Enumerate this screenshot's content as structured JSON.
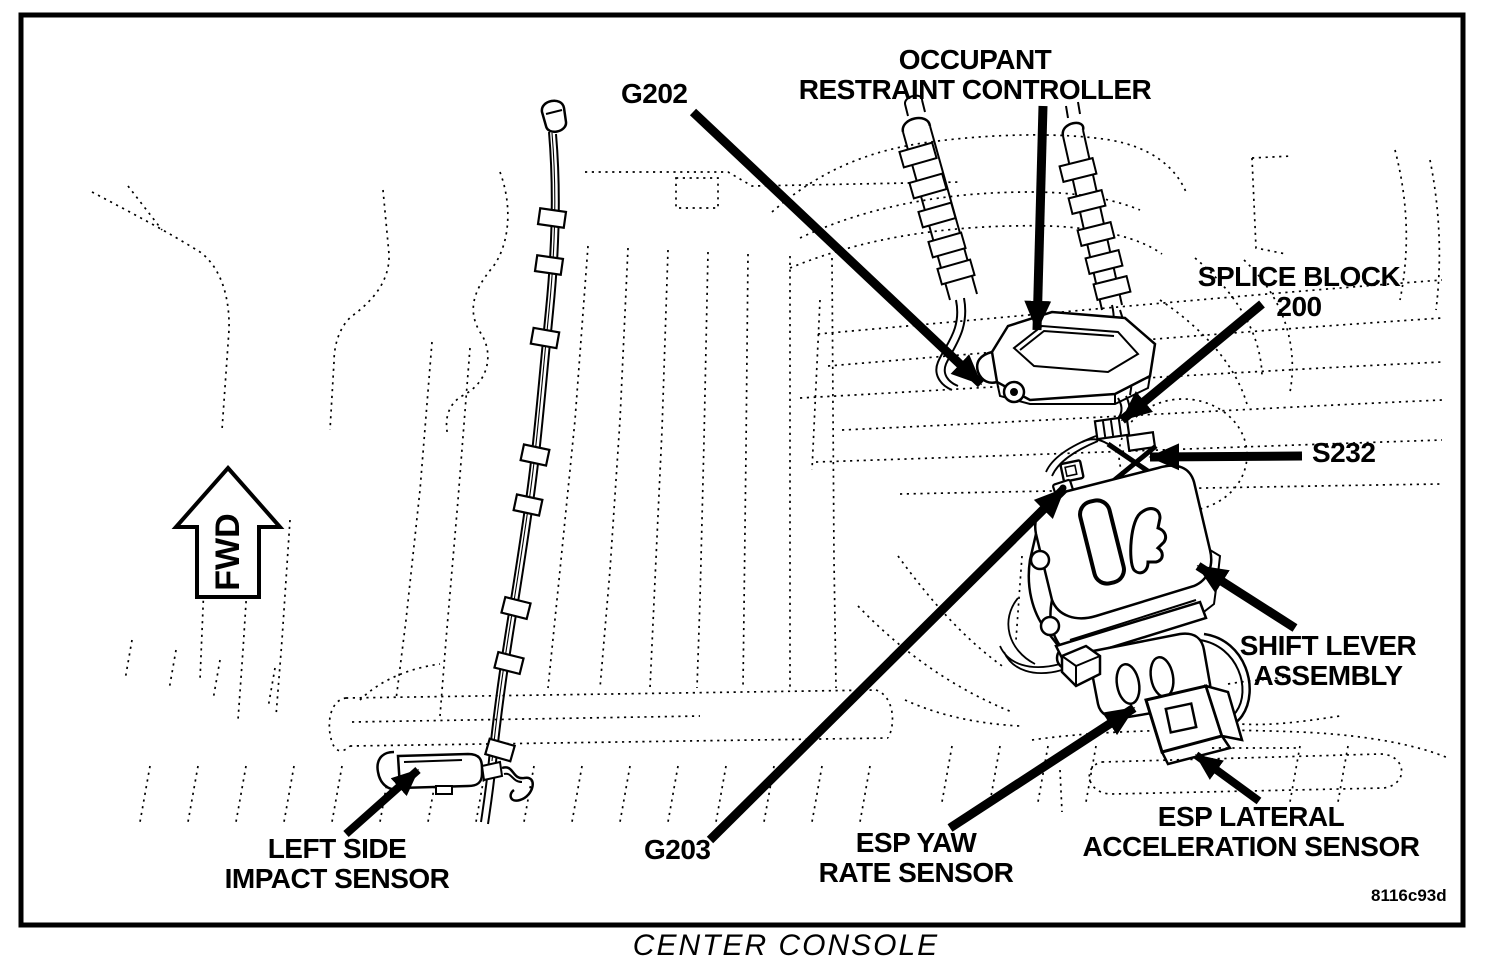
{
  "figure": {
    "caption": "CENTER CONSOLE",
    "code": "8116c93d",
    "fwd_label": "FWD"
  },
  "callouts": {
    "g202": {
      "label": "G202"
    },
    "occupant_restraint_controller": {
      "line1": "OCCUPANT",
      "line2": "RESTRAINT CONTROLLER"
    },
    "splice_block_200": {
      "line1": "SPLICE BLOCK",
      "line2": "200"
    },
    "s232": {
      "label": "S232"
    },
    "shift_lever_assembly": {
      "line1": "SHIFT LEVER",
      "line2": "ASSEMBLY"
    },
    "esp_lateral_acceleration_sensor": {
      "line1": "ESP LATERAL",
      "line2": "ACCELERATION SENSOR"
    },
    "esp_yaw_rate_sensor": {
      "line1": "ESP YAW",
      "line2": "RATE SENSOR"
    },
    "g203": {
      "label": "G203"
    },
    "left_side_impact_sensor": {
      "line1": "LEFT SIDE",
      "line2": "IMPACT SENSOR"
    }
  },
  "colors": {
    "ink": "#000000",
    "background": "#ffffff"
  }
}
